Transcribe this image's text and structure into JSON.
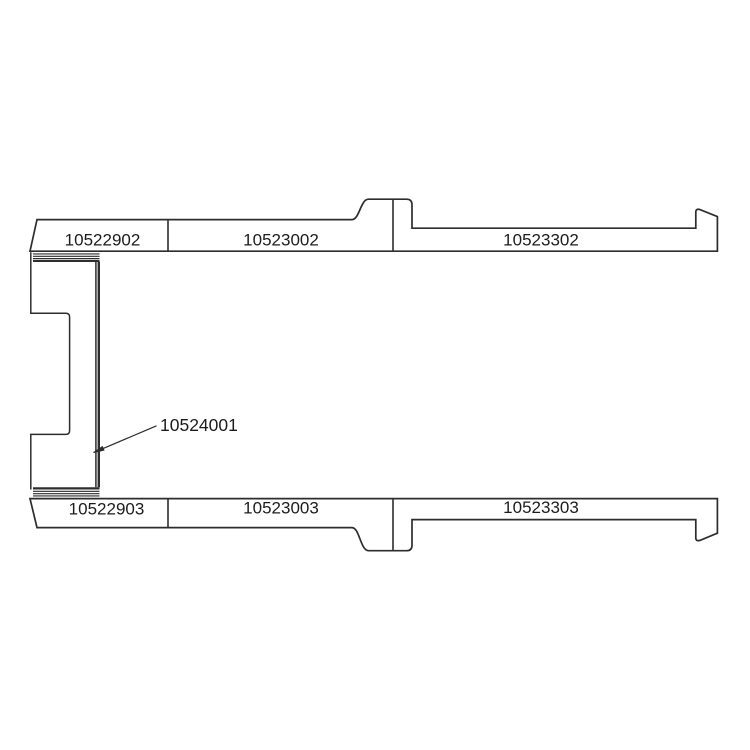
{
  "page": {
    "background": "#ffffff"
  },
  "diagram": {
    "type": "technical-parts-drawing",
    "line_color": "#2d2d2d",
    "text_color": "#1c1c1c",
    "parts": {
      "top_rail": {
        "segments": [
          {
            "label": "10522902"
          },
          {
            "label": "10523002"
          },
          {
            "label": "10523302"
          }
        ]
      },
      "bottom_rail": {
        "segments": [
          {
            "label": "10522903"
          },
          {
            "label": "10523003"
          },
          {
            "label": "10523303"
          }
        ]
      },
      "callout": {
        "label": "10524001"
      }
    }
  }
}
